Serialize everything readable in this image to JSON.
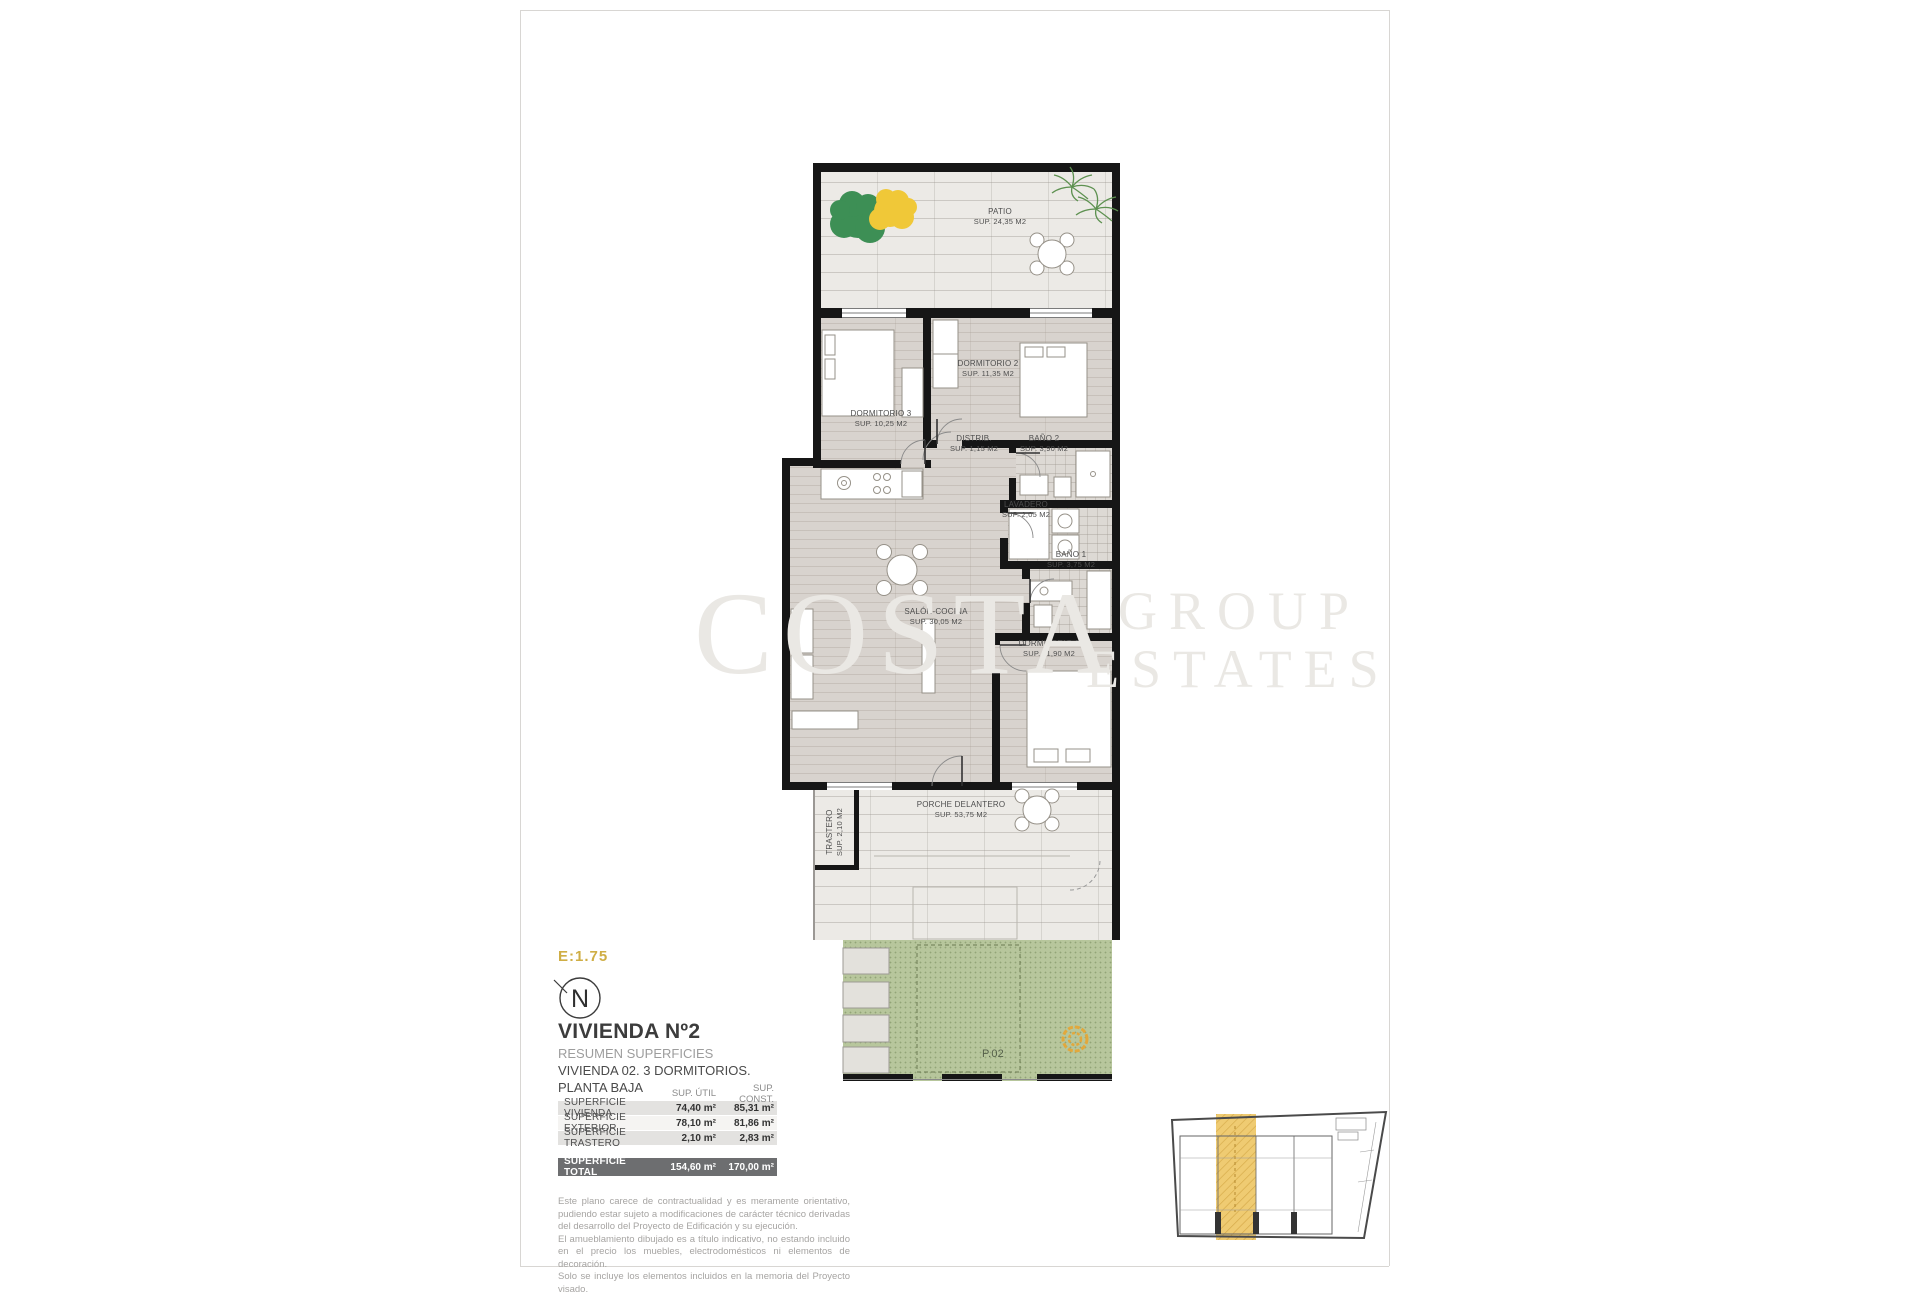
{
  "page": {
    "scale": "E:1.75",
    "north": "N"
  },
  "watermark": {
    "word1": "COSTA",
    "word2": "GROUP",
    "word3": "ESTATES"
  },
  "legend": {
    "title": "VIVIENDA Nº2",
    "subtitle": "RESUMEN SUPERFICIES",
    "description": "VIVIENDA 02. 3 DORMITORIOS.",
    "floor": "PLANTA BAJA"
  },
  "areas_table": {
    "headers": {
      "util": "SUP. ÚTIL",
      "const": "SUP. CONST."
    },
    "rows": [
      {
        "label": "SUPERFICIE VIVIENDA",
        "util": "74,40 m²",
        "const": "85,31 m²"
      },
      {
        "label": "SUPERFICIE EXTERIOR",
        "util": "78,10 m²",
        "const": "81,86 m²"
      },
      {
        "label": "SUPERFICIE TRASTERO",
        "util": "2,10 m²",
        "const": "2,83 m²"
      }
    ],
    "total": {
      "label": "SUPERFICIE TOTAL",
      "util": "154,60 m²",
      "const": "170,00 m²"
    }
  },
  "disclaimer": [
    "Este plano carece de contractualidad y es meramente orientativo, pudiendo estar sujeto a modificaciones de carácter técnico derivadas del desarrollo del Proyecto de Edificación y su ejecución.",
    "El amueblamiento dibujado es a título indicativo, no estando incluido en el precio los muebles, electrodomésticos ni elementos de decoración.",
    "Solo se incluye los elementos incluidos en la memoria del Proyecto visado."
  ],
  "rooms": [
    {
      "name": "PATIO",
      "area": "SUP. 24,35 M2"
    },
    {
      "name": "DORMITORIO 2",
      "area": "SUP. 11,35 M2"
    },
    {
      "name": "DORMITORIO 3",
      "area": "SUP. 10,25 M2"
    },
    {
      "name": "DISTRIB.",
      "area": "SUP. 1,15 M2"
    },
    {
      "name": "BAÑO 2",
      "area": "SUP. 3,90 M2"
    },
    {
      "name": "LAVADERO",
      "area": "SUP. 2,05 M2"
    },
    {
      "name": "BAÑO 1",
      "area": "SUP. 3,75 M2"
    },
    {
      "name": "SALÓN-COCINA",
      "area": "SUP. 30,05 M2"
    },
    {
      "name": "DORMITORIO 1",
      "area": "SUP. 11,90 M2"
    },
    {
      "name": "PORCHE DELANTERO",
      "area": "SUP. 53,75 M2"
    },
    {
      "name": "TRASTERO",
      "area": "SUP. 2,10 M2"
    }
  ],
  "plot": {
    "label": "P.02"
  },
  "colors": {
    "accent_gold": "#cfae45",
    "garden_green": "#b7c69c",
    "unit_highlight": "#eec766",
    "wall": "#161616"
  }
}
